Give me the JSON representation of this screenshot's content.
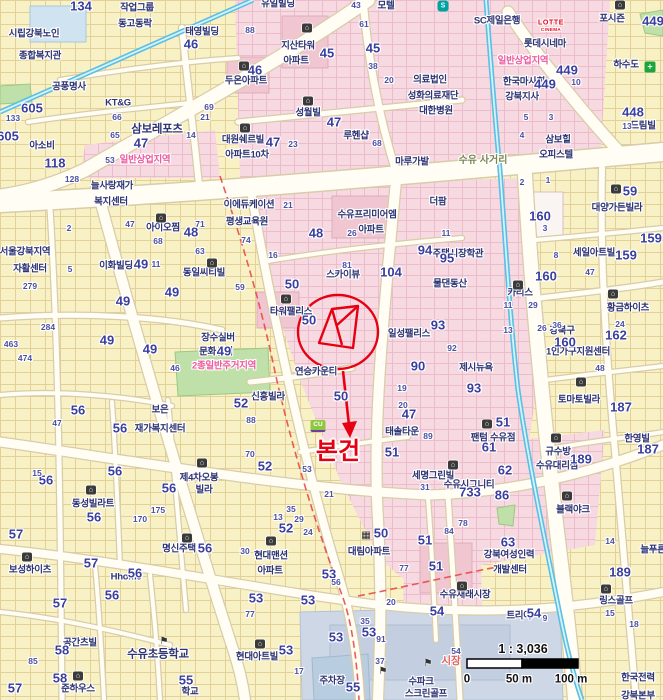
{
  "annotation": {
    "subject_label": "본건",
    "color": "#e60012"
  },
  "scale": {
    "ratio": "1 : 3,036",
    "t0": "0",
    "t50": "50 m",
    "t100": "100 m"
  },
  "colors": {
    "residential": "#f8f1c5",
    "commercial": "#f7d9e1",
    "road": "#fffdf4",
    "water": "#59bfe3",
    "park": "#bfe0a8",
    "school": "#cdd7e6",
    "label": "#2f3472",
    "zone_text": "#ee5a9e",
    "annotation": "#e60012"
  },
  "labels": [
    [
      "작업그룹",
      137,
      8,
      "n"
    ],
    [
      "동고동락",
      135,
      24,
      "n"
    ],
    [
      "태영빌딩",
      202,
      32,
      "n"
    ],
    [
      "시립강북노인",
      34,
      34,
      "n"
    ],
    [
      "종합복지관",
      40,
      56,
      "n"
    ],
    [
      "공풍명사",
      69,
      87,
      "n"
    ],
    [
      "KT&G",
      118,
      103,
      "n"
    ],
    [
      "아소비",
      42,
      146,
      "n"
    ],
    [
      "유일빌딩",
      278,
      4,
      "n"
    ],
    [
      "모텔",
      386,
      6,
      "n"
    ],
    [
      "지산타워",
      298,
      46,
      "n"
    ],
    [
      "아파트",
      296,
      61,
      "n"
    ],
    [
      "두온아파트",
      246,
      81,
      "n"
    ],
    [
      "성월빌",
      308,
      113,
      "n"
    ],
    [
      "대원쉐르빌",
      243,
      140,
      "n"
    ],
    [
      "아파트10차",
      247,
      155,
      "n"
    ],
    [
      "루헨샵",
      356,
      136,
      "n"
    ],
    [
      "마루가발",
      412,
      162,
      "n"
    ],
    [
      "SC제일은행",
      497,
      21,
      "n"
    ],
    [
      "의료법인",
      430,
      80,
      "n"
    ],
    [
      "성화의료재단",
      433,
      96,
      "n"
    ],
    [
      "대한병원",
      436,
      111,
      "n"
    ],
    [
      "롯데시네마",
      545,
      44,
      "n"
    ],
    [
      "한국마사회",
      524,
      82,
      "n"
    ],
    [
      "강북지사",
      522,
      97,
      "n"
    ],
    [
      "포시즌",
      612,
      19,
      "n"
    ],
    [
      "하수도",
      626,
      65,
      "n"
    ],
    [
      "드림빌",
      643,
      126,
      "n"
    ],
    [
      "삼보힐",
      558,
      140,
      "n"
    ],
    [
      "오피스텔",
      556,
      155,
      "n"
    ],
    [
      "늘사랑재가",
      112,
      186,
      "n"
    ],
    [
      "복지센터",
      111,
      202,
      "n"
    ],
    [
      "아이오찜",
      163,
      228,
      "n"
    ],
    [
      "서울강북지역",
      25,
      252,
      "n"
    ],
    [
      "자활센터",
      30,
      269,
      "n"
    ],
    [
      "이화빌딩",
      116,
      266,
      "n"
    ],
    [
      "동일씨티빌",
      204,
      273,
      "n"
    ],
    [
      "이에듀케이션",
      249,
      205,
      "n"
    ],
    [
      "평생교육원",
      247,
      222,
      "n"
    ],
    [
      "수유프리미어엠",
      367,
      215,
      "n"
    ],
    [
      "아파트",
      371,
      230,
      "n"
    ],
    [
      "더팜",
      438,
      202,
      "n"
    ],
    [
      "스카이뷰",
      343,
      275,
      "n"
    ],
    [
      "주택시장학관",
      458,
      254,
      "n"
    ],
    [
      "물댄동산",
      450,
      284,
      "n"
    ],
    [
      "타워팰리스",
      291,
      312,
      "n"
    ],
    [
      "일성팰리스",
      409,
      334,
      "n"
    ],
    [
      "장수실버",
      218,
      338,
      "n"
    ],
    [
      "문화센터",
      216,
      352,
      "n"
    ],
    [
      "연승카운티",
      316,
      372,
      "n"
    ],
    [
      "신흥빌라",
      268,
      397,
      "n"
    ],
    [
      "보은",
      160,
      410,
      "n"
    ],
    [
      "재가복지센터",
      160,
      429,
      "n"
    ],
    [
      "동성빌라트",
      93,
      504,
      "n"
    ],
    [
      "제4차오봉",
      199,
      478,
      "n"
    ],
    [
      "빌라",
      204,
      490,
      "n"
    ],
    [
      "태솔타운",
      402,
      432,
      "n"
    ],
    [
      "팬텀 수유점",
      493,
      438,
      "n"
    ],
    [
      "세명그린빌",
      433,
      476,
      "n"
    ],
    [
      "수유시그니티",
      469,
      485,
      "n"
    ],
    [
      "제시뉴욕",
      476,
      368,
      "n"
    ],
    [
      "토마토빌라",
      579,
      400,
      "n"
    ],
    [
      "황금하이츠",
      628,
      308,
      "n"
    ],
    [
      "강북구",
      562,
      331,
      "n"
    ],
    [
      "1인가구지원센터",
      578,
      352,
      "n"
    ],
    [
      "대양가든빌라",
      617,
      208,
      "n"
    ],
    [
      "세일아트빌",
      594,
      253,
      "n"
    ],
    [
      "카리스",
      520,
      293,
      "n"
    ],
    [
      "규수방",
      558,
      452,
      "n"
    ],
    [
      "수유대리점",
      557,
      466,
      "n"
    ],
    [
      "한영빌",
      637,
      439,
      "n"
    ],
    [
      "늘푸른",
      653,
      550,
      "n"
    ],
    [
      "강북여성인력",
      509,
      555,
      "n"
    ],
    [
      "개발센터",
      510,
      570,
      "n"
    ],
    [
      "수유재래시장",
      465,
      595,
      "n"
    ],
    [
      "링스골프",
      616,
      601,
      "n"
    ],
    [
      "블랙야크",
      573,
      510,
      "n"
    ],
    [
      "트리아",
      519,
      616,
      "n"
    ],
    [
      "현대맨션",
      271,
      556,
      "n"
    ],
    [
      "아파트",
      270,
      571,
      "n"
    ],
    [
      "대림아파트",
      369,
      552,
      "n"
    ],
    [
      "현대아트빌",
      257,
      657,
      "n"
    ],
    [
      "보성하이츠",
      30,
      570,
      "n"
    ],
    [
      "명신주택",
      179,
      549,
      "n"
    ],
    [
      "Hhome",
      126,
      577,
      "n"
    ],
    [
      "준하우스",
      78,
      689,
      "n"
    ],
    [
      "공간츠빌",
      80,
      643,
      "n"
    ],
    [
      "수파크",
      421,
      682,
      "n"
    ],
    [
      "스크린골프",
      426,
      694,
      "n"
    ],
    [
      "주차장",
      332,
      681,
      "n"
    ],
    [
      "한국전력",
      638,
      678,
      "n"
    ],
    [
      "강북본부",
      638,
      696,
      "n"
    ],
    [
      "학교",
      190,
      692,
      "n"
    ],
    [
      "삼보레포츠",
      157,
      130,
      "N"
    ],
    [
      "수유초등학교",
      158,
      655,
      "N"
    ],
    [
      "일반상업지역",
      145,
      160,
      "z"
    ],
    [
      "일반상업지역",
      523,
      61,
      "z"
    ],
    [
      "2종일반주거지역",
      224,
      366,
      "z"
    ],
    [
      "수유 사거리",
      483,
      161,
      "r"
    ],
    [
      "시장",
      451,
      661,
      "m"
    ],
    [
      "LOTTE",
      551,
      23,
      "l1"
    ],
    [
      "CINEMA",
      551,
      30,
      "l2"
    ],
    [
      "134",
      81,
      6,
      "U"
    ],
    [
      "45",
      327,
      53,
      "U"
    ],
    [
      "45",
      373,
      48,
      "U"
    ],
    [
      "46",
      255,
      70,
      "U"
    ],
    [
      "46",
      191,
      44,
      "U"
    ],
    [
      "47",
      141,
      143,
      "U"
    ],
    [
      "47",
      273,
      142,
      "U"
    ],
    [
      "47",
      334,
      122,
      "U"
    ],
    [
      "48",
      191,
      232,
      "U"
    ],
    [
      "48",
      316,
      233,
      "U"
    ],
    [
      "449",
      567,
      70,
      "U"
    ],
    [
      "449",
      545,
      84,
      "U"
    ],
    [
      "449",
      653,
      21,
      "U"
    ],
    [
      "448",
      633,
      112,
      "U"
    ],
    [
      "605",
      32,
      108,
      "U"
    ],
    [
      "605",
      8,
      136,
      "U"
    ],
    [
      "118",
      55,
      163,
      "U"
    ],
    [
      "49",
      172,
      292,
      "U"
    ],
    [
      "49",
      123,
      301,
      "U"
    ],
    [
      "49",
      107,
      340,
      "U"
    ],
    [
      "49",
      141,
      264,
      "U"
    ],
    [
      "49",
      150,
      349,
      "U"
    ],
    [
      "49",
      224,
      351,
      "U"
    ],
    [
      "50",
      292,
      284,
      "U"
    ],
    [
      "50",
      309,
      320,
      "U"
    ],
    [
      "50",
      341,
      396,
      "U"
    ],
    [
      "50",
      381,
      533,
      "U"
    ],
    [
      "104",
      391,
      272,
      "U"
    ],
    [
      "93",
      438,
      325,
      "U"
    ],
    [
      "93",
      474,
      388,
      "U"
    ],
    [
      "90",
      418,
      366,
      "U"
    ],
    [
      "95",
      447,
      258,
      "U"
    ],
    [
      "94",
      425,
      250,
      "U"
    ],
    [
      "160",
      540,
      216,
      "U"
    ],
    [
      "160",
      546,
      276,
      "U"
    ],
    [
      "160",
      565,
      342,
      "U"
    ],
    [
      "162",
      616,
      335,
      "U"
    ],
    [
      "159",
      626,
      255,
      "U"
    ],
    [
      "159",
      651,
      238,
      "U"
    ],
    [
      "59",
      630,
      191,
      "U"
    ],
    [
      "187",
      621,
      407,
      "U"
    ],
    [
      "187",
      648,
      449,
      "U"
    ],
    [
      "189",
      581,
      459,
      "U"
    ],
    [
      "189",
      620,
      572,
      "U"
    ],
    [
      "62",
      505,
      470,
      "U"
    ],
    [
      "86",
      502,
      495,
      "U"
    ],
    [
      "733",
      470,
      492,
      "U"
    ],
    [
      "52",
      241,
      403,
      "U"
    ],
    [
      "52",
      265,
      466,
      "U"
    ],
    [
      "52",
      286,
      528,
      "U"
    ],
    [
      "56",
      78,
      410,
      "U"
    ],
    [
      "56",
      120,
      428,
      "U"
    ],
    [
      "56",
      46,
      480,
      "U"
    ],
    [
      "56",
      115,
      471,
      "U"
    ],
    [
      "56",
      169,
      488,
      "U"
    ],
    [
      "56",
      94,
      517,
      "U"
    ],
    [
      "56",
      135,
      573,
      "U"
    ],
    [
      "56",
      112,
      595,
      "U"
    ],
    [
      "56",
      205,
      548,
      "U"
    ],
    [
      "57",
      91,
      563,
      "U"
    ],
    [
      "57",
      60,
      603,
      "U"
    ],
    [
      "57",
      16,
      534,
      "U"
    ],
    [
      "57",
      15,
      688,
      "U"
    ],
    [
      "58",
      62,
      650,
      "U"
    ],
    [
      "58",
      60,
      678,
      "U"
    ],
    [
      "55",
      186,
      680,
      "U"
    ],
    [
      "55",
      353,
      687,
      "U"
    ],
    [
      "53",
      256,
      598,
      "U"
    ],
    [
      "53",
      308,
      600,
      "U"
    ],
    [
      "53",
      336,
      637,
      "U"
    ],
    [
      "53",
      369,
      632,
      "U"
    ],
    [
      "53",
      286,
      650,
      "U"
    ],
    [
      "53",
      329,
      574,
      "U"
    ],
    [
      "47",
      409,
      414,
      "U"
    ],
    [
      "51",
      503,
      422,
      "U"
    ],
    [
      "61",
      489,
      447,
      "U"
    ],
    [
      "51",
      392,
      452,
      "U"
    ],
    [
      "51",
      425,
      540,
      "U"
    ],
    [
      "51",
      436,
      566,
      "U"
    ],
    [
      "54",
      534,
      613,
      "U"
    ],
    [
      "54",
      437,
      611,
      "U"
    ],
    [
      "63",
      508,
      542,
      "U"
    ],
    [
      "133",
      13,
      118,
      "u"
    ],
    [
      "463",
      11,
      344,
      "u"
    ],
    [
      "279",
      30,
      286,
      "u"
    ],
    [
      "284",
      48,
      327,
      "u"
    ],
    [
      "128",
      72,
      179,
      "u"
    ],
    [
      "474",
      25,
      358,
      "u"
    ],
    [
      "47",
      130,
      224,
      "u"
    ],
    [
      "68",
      158,
      241,
      "u"
    ],
    [
      "71",
      200,
      224,
      "u"
    ],
    [
      "63",
      200,
      251,
      "u"
    ],
    [
      "11",
      156,
      264,
      "u"
    ],
    [
      "2",
      69,
      228,
      "u"
    ],
    [
      "5",
      70,
      269,
      "u"
    ],
    [
      "66",
      117,
      117,
      "u"
    ],
    [
      "65",
      115,
      135,
      "u"
    ],
    [
      "14",
      191,
      135,
      "u"
    ],
    [
      "21",
      205,
      117,
      "u"
    ],
    [
      "69",
      209,
      107,
      "u"
    ],
    [
      "53",
      110,
      160,
      "u"
    ],
    [
      "21",
      288,
      205,
      "u"
    ],
    [
      "74",
      246,
      240,
      "u"
    ],
    [
      "16",
      273,
      255,
      "u"
    ],
    [
      "88",
      250,
      30,
      "u"
    ],
    [
      "61",
      364,
      24,
      "u"
    ],
    [
      "43",
      356,
      5,
      "u"
    ],
    [
      "38",
      373,
      66,
      "u"
    ],
    [
      "20",
      389,
      80,
      "u"
    ],
    [
      "26",
      352,
      233,
      "u"
    ],
    [
      "81",
      347,
      265,
      "u"
    ],
    [
      "23",
      293,
      144,
      "u"
    ],
    [
      "68",
      377,
      143,
      "u"
    ],
    [
      "10",
      576,
      82,
      "u"
    ],
    [
      "5",
      526,
      117,
      "u"
    ],
    [
      "3",
      551,
      117,
      "u"
    ],
    [
      "4",
      522,
      135,
      "u"
    ],
    [
      "13",
      627,
      126,
      "u"
    ],
    [
      "59",
      240,
      287,
      "u"
    ],
    [
      "88",
      251,
      420,
      "u"
    ],
    [
      "70",
      250,
      454,
      "u"
    ],
    [
      "53",
      307,
      469,
      "u"
    ],
    [
      "21",
      329,
      494,
      "u"
    ],
    [
      "35",
      291,
      509,
      "u"
    ],
    [
      "13",
      278,
      517,
      "u"
    ],
    [
      "29",
      299,
      519,
      "u"
    ],
    [
      "19",
      402,
      388,
      "u"
    ],
    [
      "20",
      403,
      405,
      "u"
    ],
    [
      "31",
      425,
      487,
      "u"
    ],
    [
      "77",
      404,
      568,
      "u"
    ],
    [
      "77",
      250,
      614,
      "u"
    ],
    [
      "20",
      391,
      602,
      "u"
    ],
    [
      "56",
      336,
      582,
      "u"
    ],
    [
      "24",
      308,
      532,
      "u"
    ],
    [
      "30",
      245,
      551,
      "u"
    ],
    [
      "17",
      299,
      671,
      "u"
    ],
    [
      "37",
      380,
      661,
      "u"
    ],
    [
      "91",
      381,
      639,
      "u"
    ],
    [
      "35",
      365,
      621,
      "u"
    ],
    [
      "15",
      37,
      473,
      "u"
    ],
    [
      "47",
      57,
      423,
      "u"
    ],
    [
      "175",
      158,
      510,
      "u"
    ],
    [
      "170",
      140,
      519,
      "u"
    ],
    [
      "46",
      175,
      368,
      "u"
    ],
    [
      "85",
      33,
      661,
      "u"
    ],
    [
      "11",
      508,
      305,
      "u"
    ],
    [
      "29",
      533,
      305,
      "u"
    ],
    [
      "13",
      508,
      330,
      "u"
    ],
    [
      "26",
      542,
      328,
      "u"
    ],
    [
      "36",
      557,
      325,
      "u"
    ],
    [
      "24",
      620,
      324,
      "u"
    ],
    [
      "47",
      590,
      272,
      "u"
    ],
    [
      "8",
      556,
      255,
      "u"
    ],
    [
      "11",
      446,
      233,
      "u"
    ],
    [
      "92",
      452,
      348,
      "u"
    ],
    [
      "48",
      600,
      368,
      "u"
    ],
    [
      "14",
      610,
      541,
      "u"
    ],
    [
      "18",
      634,
      624,
      "u"
    ],
    [
      "54",
      456,
      651,
      "u"
    ],
    [
      "78",
      463,
      523,
      "u"
    ],
    [
      "84",
      449,
      531,
      "u"
    ],
    [
      "89",
      428,
      436,
      "u"
    ],
    [
      "15",
      610,
      613,
      "u"
    ],
    [
      "9",
      545,
      618,
      "u"
    ],
    [
      "2",
      522,
      182,
      "u"
    ],
    [
      "1",
      548,
      180,
      "u"
    ],
    [
      "3",
      545,
      228,
      "u"
    ]
  ],
  "icons": [
    [
      244,
      66,
      "b"
    ],
    [
      307,
      28,
      "b"
    ],
    [
      308,
      101,
      "b"
    ],
    [
      245,
      128,
      "b"
    ],
    [
      161,
      218,
      "b"
    ],
    [
      212,
      263,
      "b"
    ],
    [
      286,
      299,
      "b"
    ],
    [
      518,
      285,
      "b"
    ],
    [
      613,
      294,
      "b"
    ],
    [
      616,
      189,
      "b"
    ],
    [
      487,
      424,
      "b"
    ],
    [
      556,
      438,
      "b"
    ],
    [
      567,
      496,
      "b"
    ],
    [
      453,
      465,
      "b"
    ],
    [
      581,
      382,
      "b"
    ],
    [
      187,
      538,
      "b"
    ],
    [
      27,
      557,
      "b"
    ],
    [
      91,
      490,
      "b"
    ],
    [
      202,
      463,
      "b"
    ],
    [
      271,
      541,
      "b"
    ],
    [
      462,
      586,
      "b"
    ],
    [
      606,
      589,
      "b"
    ],
    [
      260,
      644,
      "b"
    ],
    [
      78,
      676,
      "b"
    ],
    [
      620,
      5,
      "b"
    ],
    [
      366,
      536,
      "grid"
    ],
    [
      164,
      642,
      "flag"
    ],
    [
      383,
      672,
      "flag"
    ],
    [
      428,
      664,
      "flag"
    ],
    [
      650,
      67,
      "cross"
    ],
    [
      318,
      426,
      "cu"
    ],
    [
      443,
      6,
      "subway"
    ]
  ]
}
